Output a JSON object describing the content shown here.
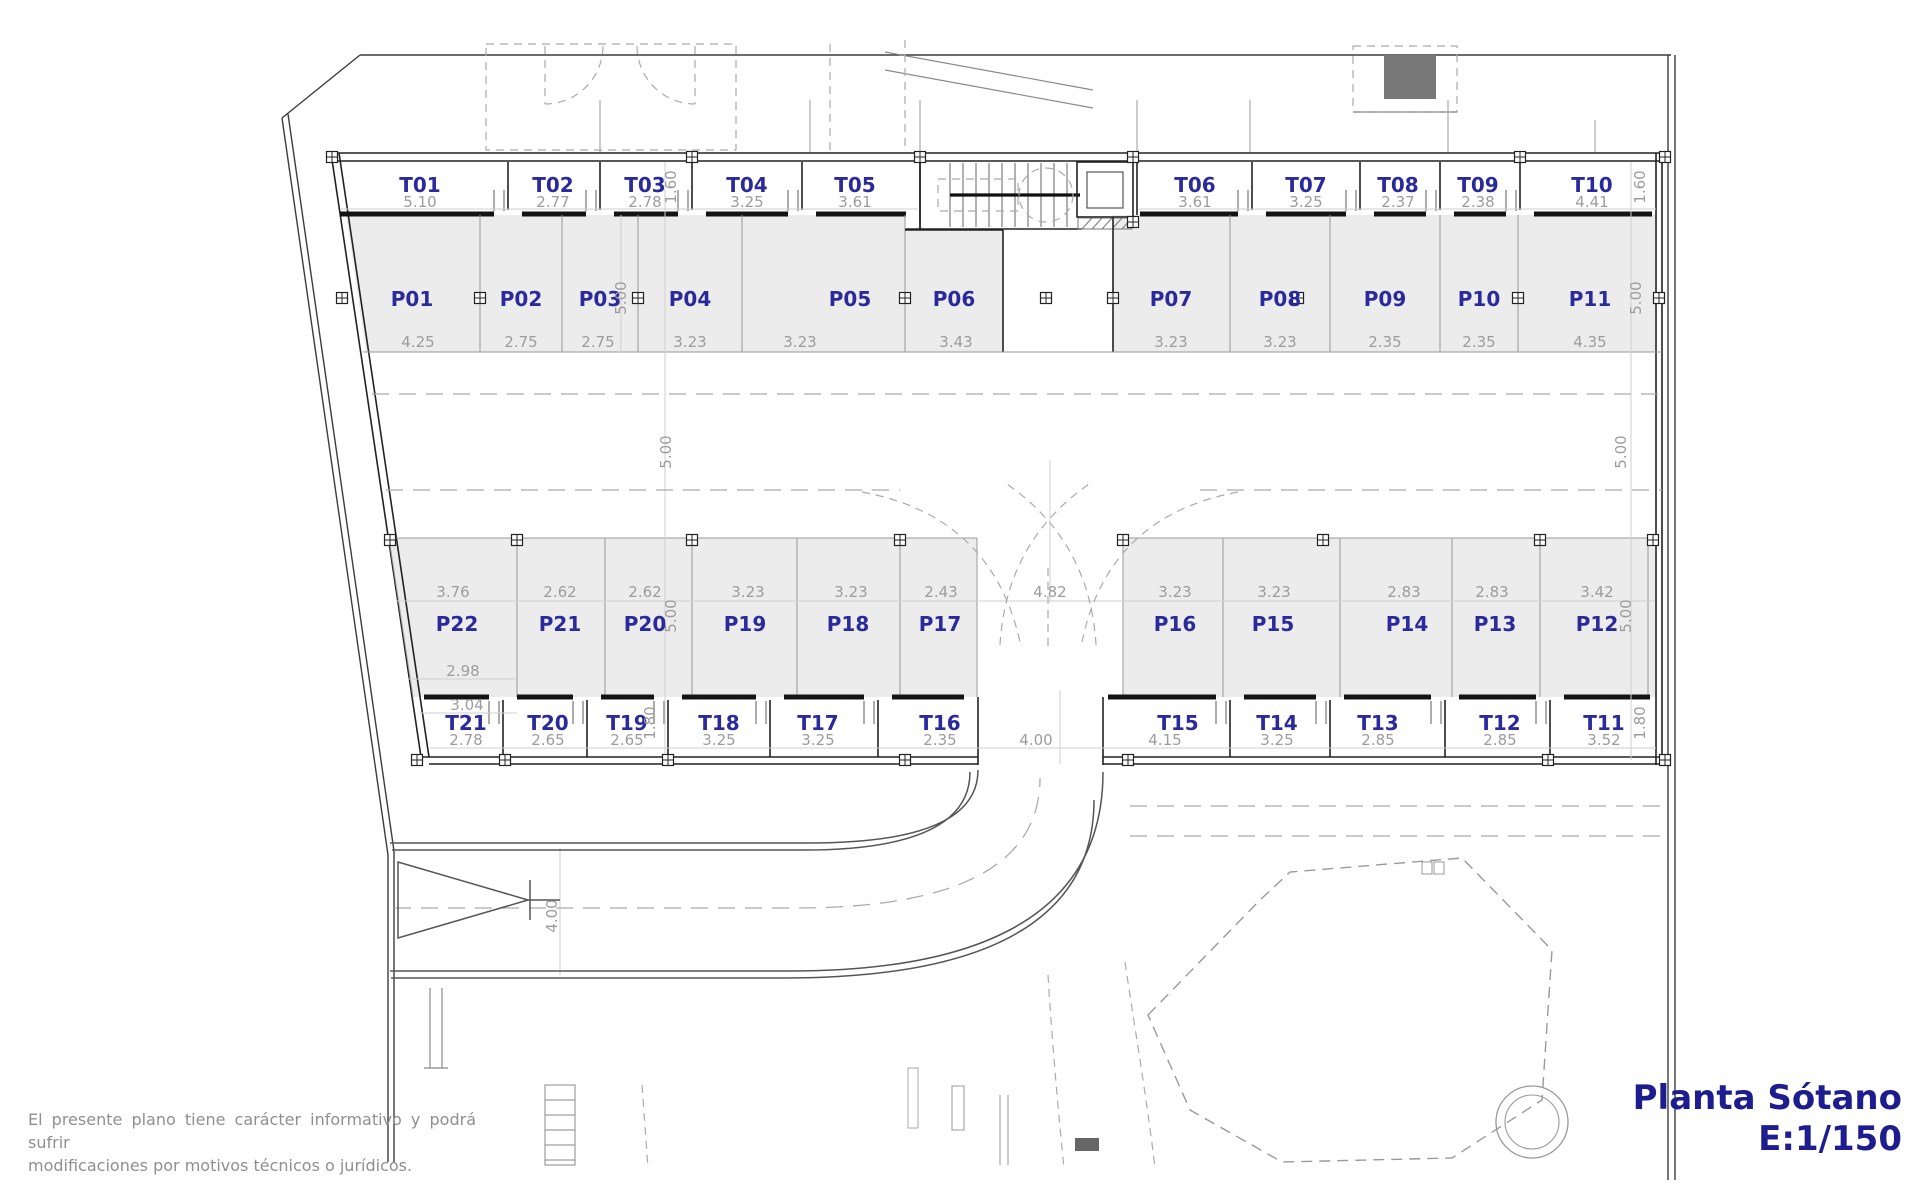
{
  "plan": {
    "storage_top": [
      {
        "id": "T01",
        "dim": "5.10"
      },
      {
        "id": "T02",
        "dim": "2.77"
      },
      {
        "id": "T03",
        "dim": "2.78"
      },
      {
        "id": "T04",
        "dim": "3.25"
      },
      {
        "id": "T05",
        "dim": "3.61"
      },
      {
        "id": "T06",
        "dim": "3.61"
      },
      {
        "id": "T07",
        "dim": "3.25"
      },
      {
        "id": "T08",
        "dim": "2.37"
      },
      {
        "id": "T09",
        "dim": "2.38"
      },
      {
        "id": "T10",
        "dim": "4.41"
      }
    ],
    "parking_top": [
      {
        "id": "P01",
        "dim": "4.25"
      },
      {
        "id": "P02",
        "dim": "2.75"
      },
      {
        "id": "P03",
        "dim": "2.75"
      },
      {
        "id": "P04",
        "dim": "3.23"
      },
      {
        "id": "P05",
        "dim": "3.23"
      },
      {
        "id": "P06",
        "dim": "3.43"
      },
      {
        "id": "P07",
        "dim": "3.23"
      },
      {
        "id": "P08",
        "dim": "3.23"
      },
      {
        "id": "P09",
        "dim": "2.35"
      },
      {
        "id": "P10",
        "dim": "2.35"
      },
      {
        "id": "P11",
        "dim": "4.35"
      }
    ],
    "parking_bottom": [
      {
        "id": "P22",
        "dim": "3.76"
      },
      {
        "id": "P21",
        "dim": "2.62"
      },
      {
        "id": "P20",
        "dim": "2.62"
      },
      {
        "id": "P19",
        "dim": "3.23"
      },
      {
        "id": "P18",
        "dim": "3.23"
      },
      {
        "id": "P17",
        "dim": "2.43"
      },
      {
        "id": "P16",
        "dim": "3.23"
      },
      {
        "id": "P15",
        "dim": "3.23"
      },
      {
        "id": "P14",
        "dim": "2.83"
      },
      {
        "id": "P13",
        "dim": "2.83"
      },
      {
        "id": "P12",
        "dim": "3.42"
      }
    ],
    "storage_bottom": [
      {
        "id": "T21",
        "dim": "2.78"
      },
      {
        "id": "T20",
        "dim": "2.65"
      },
      {
        "id": "T19",
        "dim": "2.65"
      },
      {
        "id": "T18",
        "dim": "3.25"
      },
      {
        "id": "T17",
        "dim": "3.25"
      },
      {
        "id": "T16",
        "dim": "2.35"
      },
      {
        "id": "T15",
        "dim": "4.15"
      },
      {
        "id": "T14",
        "dim": "3.25"
      },
      {
        "id": "T13",
        "dim": "2.85"
      },
      {
        "id": "T12",
        "dim": "2.85"
      },
      {
        "id": "T11",
        "dim": "3.52"
      }
    ],
    "dims": {
      "band_top": "1.60",
      "band_bottom": "1.80",
      "stall_depth": "5.00",
      "aisle_center": "4.82",
      "ramp_gap": "4.00",
      "ramp_left": "4.00",
      "extra_a": "2.98",
      "extra_b": "3.04"
    }
  },
  "titleblock": {
    "line1": "Planta Sótano",
    "line2": "E:1/150"
  },
  "disclaimer": {
    "line1": "El presente plano tiene carácter informativo y podrá sufrir",
    "line2": "modificaciones por motivos técnicos o jurídicos."
  },
  "colors": {
    "label_blue": "#2A2A9C",
    "dim_gray": "#9C9C9C",
    "title_navy": "#1D1D8F",
    "stall_fill": "#ECECEC",
    "wall_dark": "#222222"
  }
}
